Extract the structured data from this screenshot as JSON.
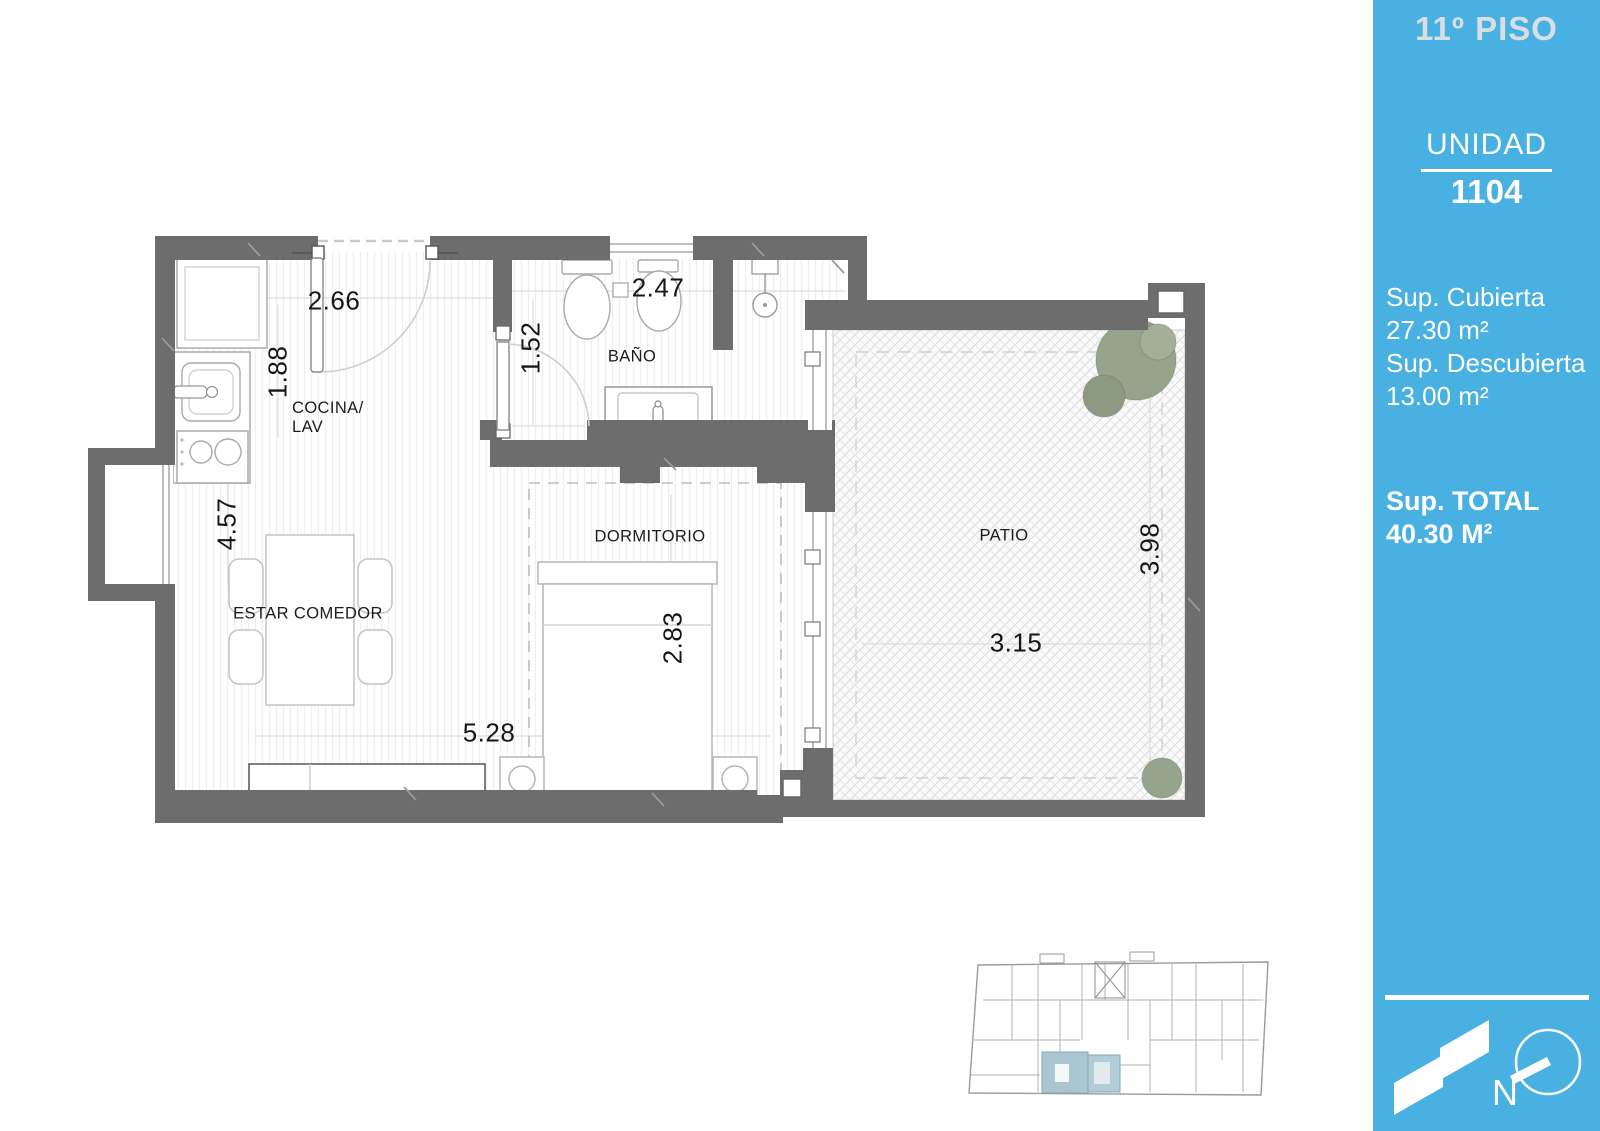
{
  "sidebar": {
    "floor_title": "11º PISO",
    "unit_label": "UNIDAD",
    "unit_number": "1104",
    "areas": [
      {
        "label": "Sup. Cubierta",
        "value": "27.30 m²"
      },
      {
        "label": "Sup. Descubierta",
        "value": "13.00 m²"
      }
    ],
    "total_label": "Sup. TOTAL",
    "total_value": "40.30 M²",
    "north_letter": "N",
    "bg_color": "#48b1e2"
  },
  "plan": {
    "wall_color": "#6d6d6d",
    "highlight_color": "#aac7d0",
    "rooms": [
      {
        "label": "COCINA/\nLAV"
      },
      {
        "label": "BAÑO"
      },
      {
        "label": "DORMITORIO"
      },
      {
        "label": "ESTAR COMEDOR"
      },
      {
        "label": "PATIO"
      }
    ],
    "dimensions": [
      {
        "value": "2.66"
      },
      {
        "value": "1.88"
      },
      {
        "value": "1.52"
      },
      {
        "value": "2.47"
      },
      {
        "value": "4.57"
      },
      {
        "value": "2.83"
      },
      {
        "value": "5.28"
      },
      {
        "value": "3.15"
      },
      {
        "value": "3.98"
      }
    ]
  }
}
